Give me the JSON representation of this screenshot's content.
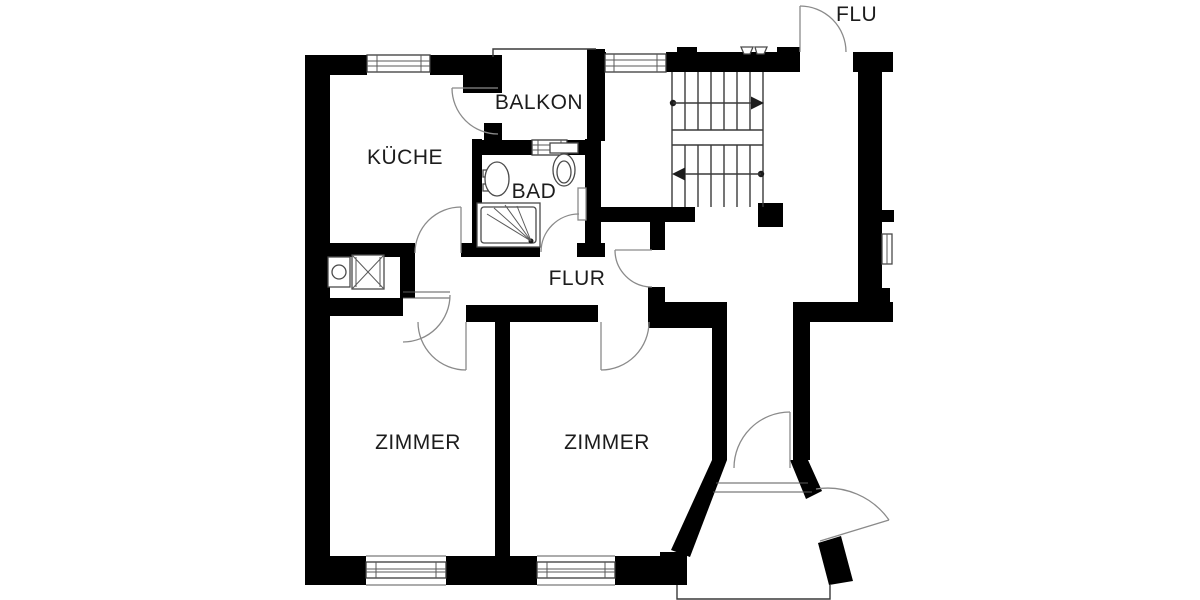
{
  "floorplan": {
    "rooms": {
      "kueche": "KÜCHE",
      "balkon": "BALKON",
      "bad": "BAD",
      "flur": "FLUR",
      "zimmer_left": "ZIMMER",
      "zimmer_right": "ZIMMER",
      "stairhall": "FLU"
    },
    "colors": {
      "wall": "#000000",
      "background": "#ffffff",
      "thin_line": "#3a3a3a",
      "door_arc": "#8a8a8a",
      "text": "#1c1c1c"
    }
  }
}
